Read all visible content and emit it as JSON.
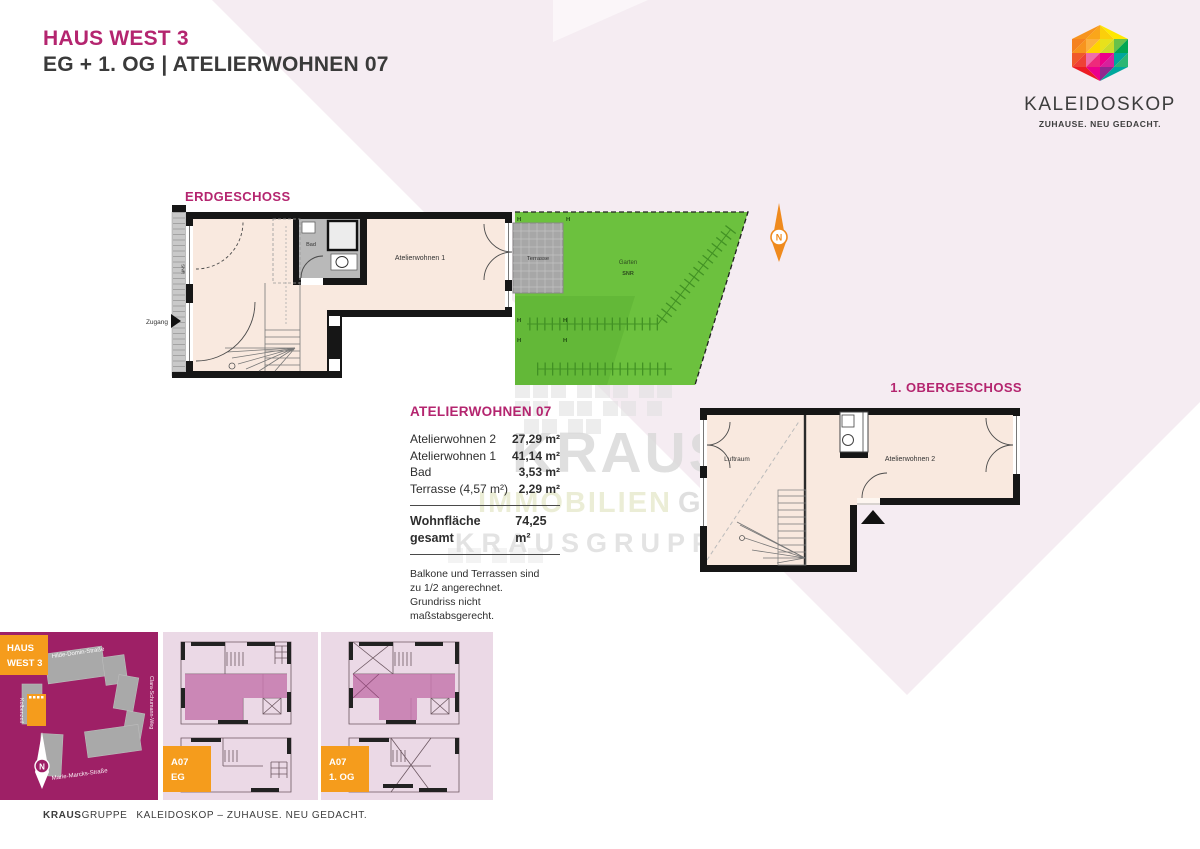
{
  "header": {
    "title": "HAUS WEST 3",
    "subtitle": "EG + 1. OG | ATELIERWOHNEN 07"
  },
  "logo": {
    "name": "KALEIDOSKOP",
    "tagline": "ZUHAUSE. NEU GEDACHT."
  },
  "floorplans": {
    "eg": {
      "title": "ERDGESCHOSS",
      "strip": "SNR",
      "entry": "Zugang",
      "bath": "Bad",
      "room1": "Atelierwohnen 1",
      "terrace": "Terrasse",
      "garden": "Garten",
      "garden_sub": "SNR",
      "hedge": "H",
      "north": "N"
    },
    "og": {
      "title": "1. OBERGESCHOSS",
      "void": "Luftraum",
      "room2": "Atelierwohnen 2"
    }
  },
  "area_table": {
    "title": "ATELIERWOHNEN 07",
    "rows": [
      {
        "label": "Atelierwohnen 2",
        "value": "27,29 m²"
      },
      {
        "label": "Atelierwohnen 1",
        "value": "41,14 m²"
      },
      {
        "label": "Bad",
        "value": "3,53 m²"
      },
      {
        "label": "Terrasse (4,57 m²)",
        "value": "2,29 m²"
      }
    ],
    "total_label": "Wohnfläche gesamt",
    "total_value": "74,25 m²",
    "notes": [
      "Balkone und Terrassen sind",
      "zu 1/2 angerechnet.",
      "Grundriss nicht maßstabsgerecht."
    ]
  },
  "watermark": {
    "word1": "KRAUS",
    "word2": "IMMOBILIEN",
    "word3": "GMBH",
    "word4": "KRAUSGRUPPE"
  },
  "site_plan": {
    "badge_top": "HAUS",
    "badge_bottom": "WEST 3",
    "street_top": "Hilde-Domin-Straße",
    "street_right": "Clara-Schumann-Weg",
    "street_left": "Kolbenzeil",
    "street_bottom": "Marie-Marcks-Straße",
    "north": "N"
  },
  "mini_plans": [
    {
      "badge_top": "A07",
      "badge_bottom": "EG"
    },
    {
      "badge_top": "A07",
      "badge_bottom": "1. OG"
    }
  ],
  "footer": {
    "brand_bold": "KRAUS",
    "brand_rest": "GRUPPE",
    "tagline": "KALEIDOSKOP – ZUHAUSE. NEU GEDACHT."
  },
  "colors": {
    "magenta": "#b4256f",
    "site_magenta": "#9e2066",
    "orange": "#f59c1c",
    "garden_green": "#6cc13e",
    "floor_cream": "#f9e9df",
    "pink_background": "#f5ecf2",
    "panel_pink": "#ebd9e6",
    "unit_highlight": "#c678ad"
  }
}
